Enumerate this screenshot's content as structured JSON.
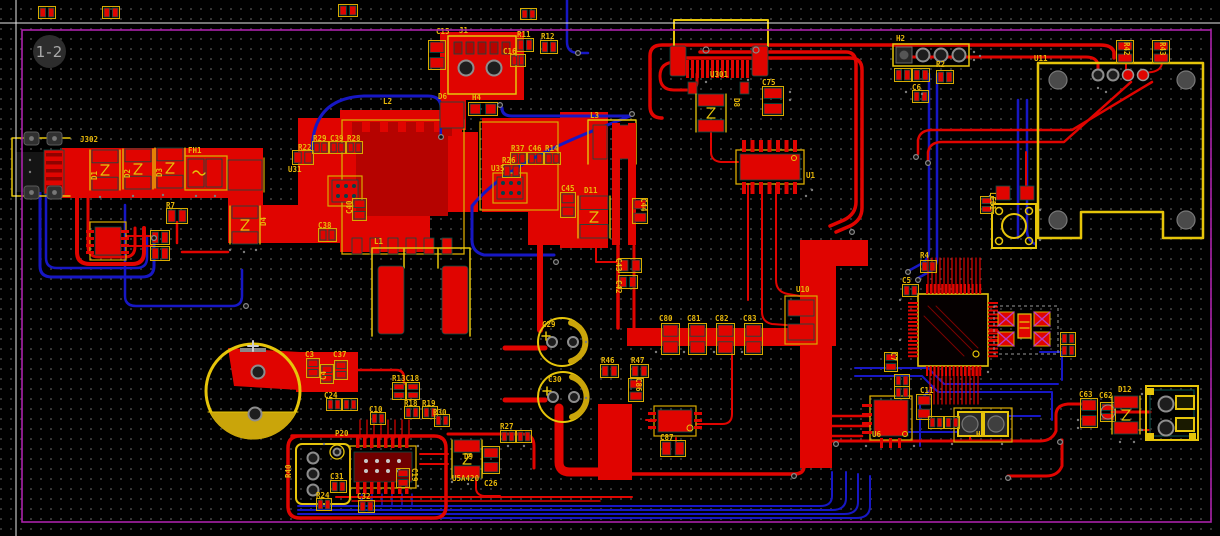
{
  "page_indicator": "1-2",
  "colors": {
    "background": "#000000",
    "copper_top": "#e00400",
    "copper_dark": "#b50300",
    "copper_bottom": "#1717c4",
    "silkscreen": "#d9ab00",
    "silkscreen_bright": "#e6c50a",
    "label_text": "#e8b80a",
    "board_outline": "#aa22aa",
    "keepout_hatch": "#c03cc0",
    "pad_clearance": "#0a4f46",
    "grid_dot": "#454545",
    "crosshair": "#e8e8e8",
    "hole": "#1d1d1d",
    "ring": "#8d8d8d",
    "indicator_bg": "#2d2d2d",
    "indicator_text": "#a9a9a9"
  },
  "board": {
    "outline_shape": "rectangle",
    "layers_visible": [
      "top-copper",
      "bottom-copper",
      "silkscreen",
      "board-edge"
    ]
  },
  "labels": [
    {
      "t": "J302",
      "x": 80,
      "y": 142
    },
    {
      "t": "D1",
      "x": 97,
      "y": 180,
      "r": -90
    },
    {
      "t": "D2",
      "x": 130,
      "y": 178,
      "r": -90
    },
    {
      "t": "D3",
      "x": 162,
      "y": 177,
      "r": -90
    },
    {
      "t": "FH1",
      "x": 188,
      "y": 153
    },
    {
      "t": "D4",
      "x": 266,
      "y": 226,
      "r": -90
    },
    {
      "t": "R7",
      "x": 166,
      "y": 208
    },
    {
      "t": "R22",
      "x": 298,
      "y": 150
    },
    {
      "t": "R29",
      "x": 313,
      "y": 141
    },
    {
      "t": "C39",
      "x": 330,
      "y": 141
    },
    {
      "t": "R28",
      "x": 347,
      "y": 141
    },
    {
      "t": "U31",
      "x": 288,
      "y": 172
    },
    {
      "t": "L2",
      "x": 383,
      "y": 104
    },
    {
      "t": "L1",
      "x": 374,
      "y": 244
    },
    {
      "t": "C40",
      "x": 352,
      "y": 214,
      "r": -90
    },
    {
      "t": "C38",
      "x": 318,
      "y": 228
    },
    {
      "t": "C15",
      "x": 436,
      "y": 34
    },
    {
      "t": "J1",
      "x": 459,
      "y": 33
    },
    {
      "t": "R11",
      "x": 517,
      "y": 37
    },
    {
      "t": "R12",
      "x": 541,
      "y": 39
    },
    {
      "t": "C16",
      "x": 503,
      "y": 54
    },
    {
      "t": "D6",
      "x": 438,
      "y": 99
    },
    {
      "t": "H4",
      "x": 472,
      "y": 100
    },
    {
      "t": "R26",
      "x": 502,
      "y": 163
    },
    {
      "t": "R37",
      "x": 511,
      "y": 151
    },
    {
      "t": "C46",
      "x": 528,
      "y": 151
    },
    {
      "t": "R14",
      "x": 545,
      "y": 151
    },
    {
      "t": "U35",
      "x": 491,
      "y": 171
    },
    {
      "t": "C45",
      "x": 561,
      "y": 191
    },
    {
      "t": "D11",
      "x": 584,
      "y": 193
    },
    {
      "t": "L3",
      "x": 590,
      "y": 118
    },
    {
      "t": "C44",
      "x": 641,
      "y": 198,
      "r": 90
    },
    {
      "t": "C43",
      "x": 616,
      "y": 258,
      "r": 90
    },
    {
      "t": "C42",
      "x": 616,
      "y": 280,
      "r": 90
    },
    {
      "t": "U301",
      "x": 710,
      "y": 77
    },
    {
      "t": "D8",
      "x": 734,
      "y": 98,
      "r": 90
    },
    {
      "t": "C75",
      "x": 762,
      "y": 85
    },
    {
      "t": "U1",
      "x": 806,
      "y": 178
    },
    {
      "t": "H2",
      "x": 896,
      "y": 41
    },
    {
      "t": "R2",
      "x": 936,
      "y": 67
    },
    {
      "t": "C6",
      "x": 912,
      "y": 90
    },
    {
      "t": "R42",
      "x": 1124,
      "y": 42,
      "r": 90
    },
    {
      "t": "R43",
      "x": 1160,
      "y": 42,
      "r": 90
    },
    {
      "t": "U11",
      "x": 1034,
      "y": 61
    },
    {
      "t": "LED1",
      "x": 990,
      "y": 192,
      "r": 90
    },
    {
      "t": "R4",
      "x": 920,
      "y": 258
    },
    {
      "t": "C5",
      "x": 902,
      "y": 283
    },
    {
      "t": "C7",
      "x": 891,
      "y": 352,
      "r": 90
    },
    {
      "t": "U10",
      "x": 796,
      "y": 292
    },
    {
      "t": "C80",
      "x": 659,
      "y": 321
    },
    {
      "t": "C81",
      "x": 687,
      "y": 321
    },
    {
      "t": "C82",
      "x": 715,
      "y": 321
    },
    {
      "t": "C83",
      "x": 743,
      "y": 321
    },
    {
      "t": "C29",
      "x": 542,
      "y": 327
    },
    {
      "t": "C30",
      "x": 548,
      "y": 382
    },
    {
      "t": "R46",
      "x": 601,
      "y": 363
    },
    {
      "t": "R47",
      "x": 631,
      "y": 363
    },
    {
      "t": "C86",
      "x": 636,
      "y": 378,
      "r": 90
    },
    {
      "t": "C87",
      "x": 660,
      "y": 440
    },
    {
      "t": "C3",
      "x": 305,
      "y": 357
    },
    {
      "t": "C4",
      "x": 326,
      "y": 380,
      "r": -90
    },
    {
      "t": "C37",
      "x": 333,
      "y": 357
    },
    {
      "t": "R13C18",
      "x": 392,
      "y": 381
    },
    {
      "t": "C24",
      "x": 324,
      "y": 398
    },
    {
      "t": "C10",
      "x": 369,
      "y": 412
    },
    {
      "t": "R18",
      "x": 404,
      "y": 406
    },
    {
      "t": "R19",
      "x": 422,
      "y": 406
    },
    {
      "t": "R30",
      "x": 433,
      "y": 415
    },
    {
      "t": "P20",
      "x": 335,
      "y": 436
    },
    {
      "t": "R40",
      "x": 291,
      "y": 478,
      "r": -90
    },
    {
      "t": "C31",
      "x": 330,
      "y": 479
    },
    {
      "t": "U5A420",
      "x": 452,
      "y": 481
    },
    {
      "t": "C19",
      "x": 412,
      "y": 468,
      "r": 90
    },
    {
      "t": "R24",
      "x": 316,
      "y": 498
    },
    {
      "t": "C32",
      "x": 357,
      "y": 499
    },
    {
      "t": "D9",
      "x": 464,
      "y": 459
    },
    {
      "t": "C26",
      "x": 484,
      "y": 486
    },
    {
      "t": "R27",
      "x": 500,
      "y": 429
    },
    {
      "t": "C63",
      "x": 1079,
      "y": 397
    },
    {
      "t": "C62",
      "x": 1099,
      "y": 398
    },
    {
      "t": "D12",
      "x": 1118,
      "y": 392
    },
    {
      "t": "C11",
      "x": 920,
      "y": 393
    },
    {
      "t": "U6",
      "x": 872,
      "y": 437
    },
    {
      "t": "H1",
      "x": 976,
      "y": 437
    }
  ]
}
